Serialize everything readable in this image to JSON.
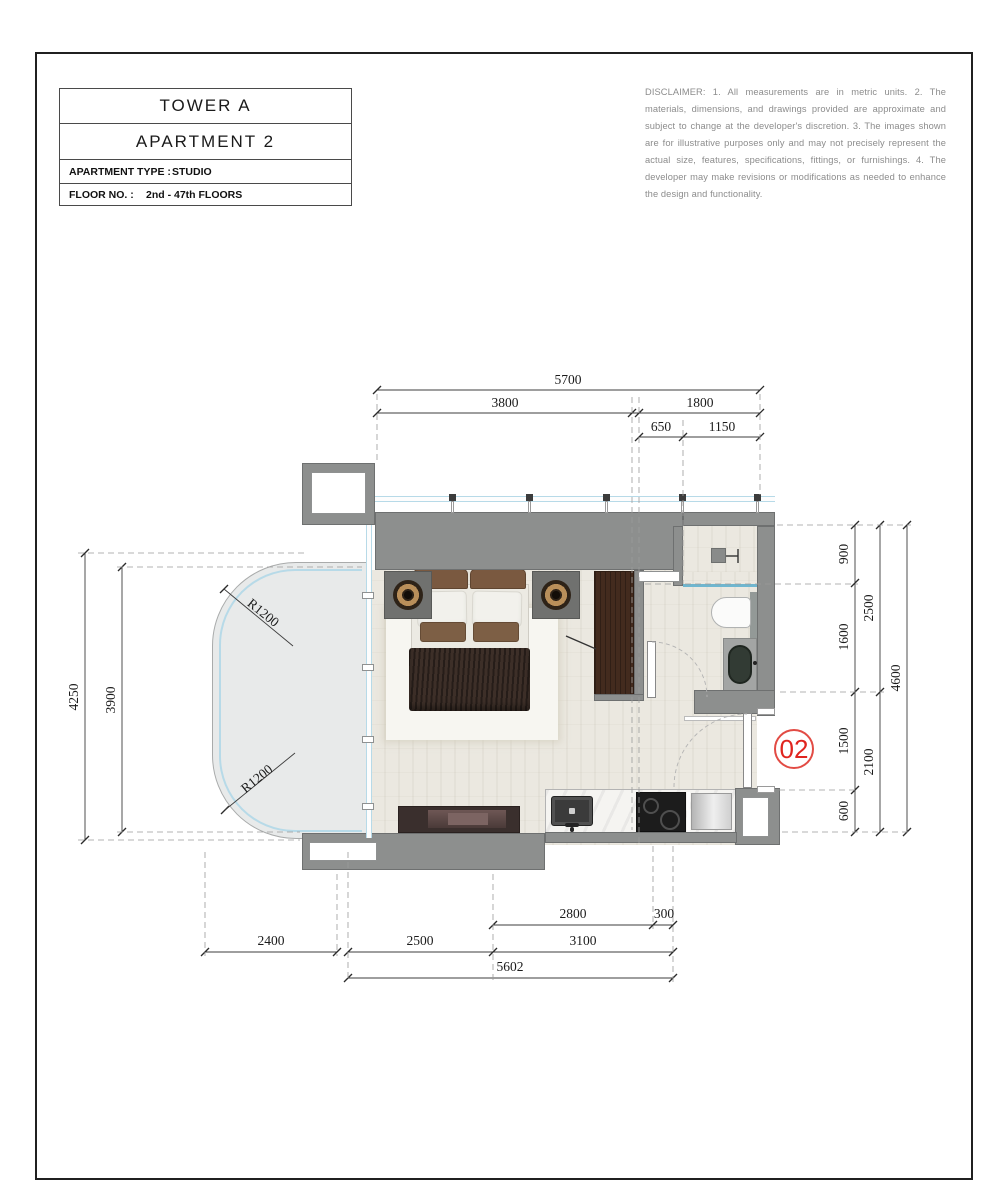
{
  "title_block": {
    "tower": "TOWER A",
    "apartment": "APARTMENT 2",
    "type_label": "APARTMENT TYPE :",
    "type_value": "STUDIO",
    "floor_label": "FLOOR NO. :",
    "floor_value": "2nd - 47th FLOORS"
  },
  "disclaimer": "DISCLAIMER: 1. All measurements are in metric units. 2. The materials, dimensions, and drawings provided are approximate and subject to change at the developer's discretion. 3. The images shown are for illustrative purposes only and may not precisely represent the actual size, features, specifications, fittings, or furnishings. 4. The developer may make revisions or modifications as needed to enhance the design and functionality.",
  "unit_marker": "02",
  "dims": {
    "top_total": "5700",
    "top_left": "3800",
    "top_right": "1800",
    "top_sub_left": "650",
    "top_sub_right": "1150",
    "left_outer": "4250",
    "left_inner": "3900",
    "right_seg_1": "900",
    "right_seg_2": "1600",
    "right_seg_3": "1500",
    "right_seg_4": "600",
    "right_mid_1": "2500",
    "right_mid_2": "2100",
    "right_total": "4600",
    "bottom_upper_1": "2800",
    "bottom_upper_2": "300",
    "bottom_mid_1": "2400",
    "bottom_mid_2": "2500",
    "bottom_mid_3": "3100",
    "bottom_total": "5602",
    "radius_top": "R1200",
    "radius_bottom": "R1200"
  },
  "colors": {
    "wall": "#8d8f8e",
    "glass": "#b7dae8",
    "floor": "#ebe8e0",
    "balcony_floor": "#e8eaea",
    "marker_red": "#e0251f"
  }
}
